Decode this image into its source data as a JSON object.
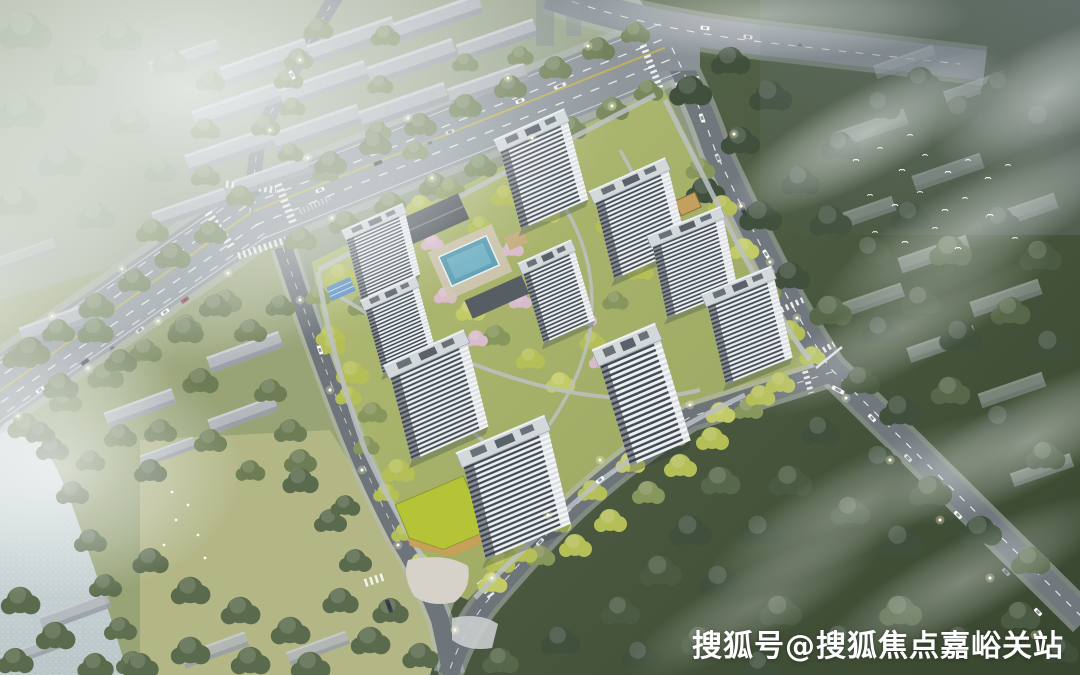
{
  "watermark": {
    "text": "搜狐号@搜狐焦点嘉峪关站"
  },
  "scene": {
    "description": "Aerial architectural rendering: residential compound of ten white high-rise towers around a pool courtyard, bounded by a wide avenue and tree-lined roads, with river, meadow, low-rise slab blocks and foggy forest around, white bird flock over the trees",
    "tower_count": 10
  },
  "palette": {
    "road": "#787f85",
    "road_major": "#8f979d",
    "marking": "#ffffff",
    "median_yellow": "#c9b84e",
    "tower_face": "#edf0f3",
    "tower_stripe": "#414a52",
    "tower_roof": "#d3d8db",
    "slab_gray": "#b3b8bd",
    "lawn": "#a6b169",
    "tree_yellow": "#b5bf58",
    "tree_mid": "#76855c",
    "forest_dark": "#46543f",
    "water": "#ccd7d9",
    "pool": "#5f9fb3",
    "court_blue": "#5b8fc2",
    "podium_roof": "#b5c437",
    "podium_wall": "#c89f58",
    "blossom": "#d9bccb",
    "fog": "#e8eeee"
  }
}
